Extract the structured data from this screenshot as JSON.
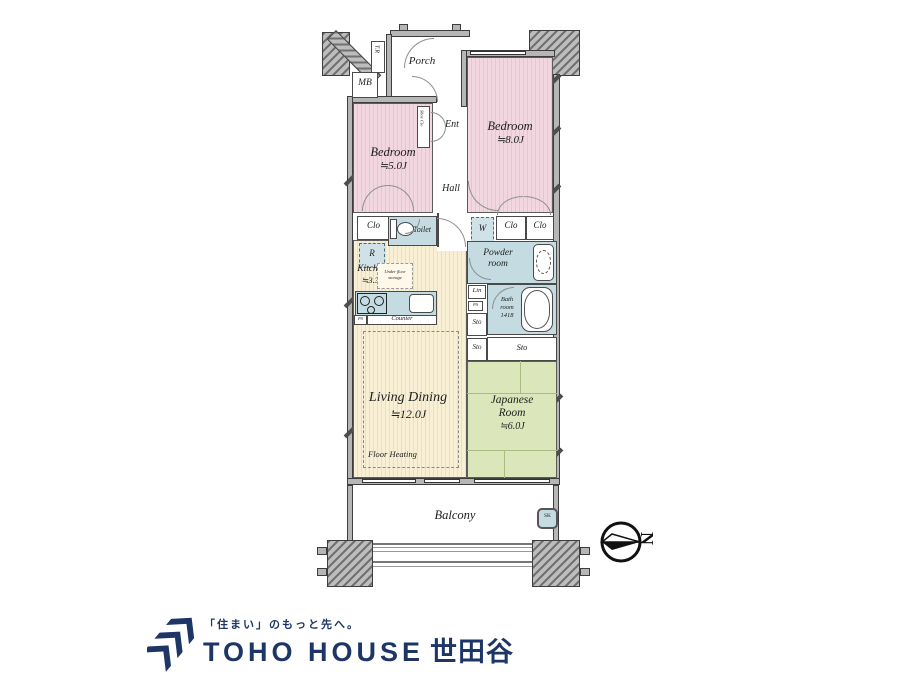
{
  "floorplan": {
    "rooms": {
      "porch": "Porch",
      "tr": "T.R",
      "mb": "MB",
      "shoe_clo": "Shoe Clo",
      "ent": "Ent",
      "hall": "Hall",
      "bedroom5_name": "Bedroom",
      "bedroom5_size": "≒5.0J",
      "bedroom8_name": "Bedroom",
      "bedroom8_size": "≒8.0J",
      "clo": "Clo",
      "ps": "PS",
      "toilet": "Toilet",
      "refrigerator": "R",
      "kitchen_name": "Kitchen",
      "kitchen_size": "≒3.3J",
      "underfloor_line1": "Under floor",
      "underfloor_line2": "storage",
      "counter": "Counter",
      "washer": "W",
      "powder_line1": "Powder",
      "powder_line2": "room",
      "lin": "Lin",
      "sto": "Sto",
      "bath_line1": "Bath",
      "bath_line2": "room",
      "bath_line3": "1418",
      "living_name": "Living Dining",
      "living_size": "≒12.0J",
      "floor_heating": "Floor Heating",
      "japanese_line1": "Japanese",
      "japanese_line2": "Room",
      "japanese_size": "≒6.0J",
      "balcony": "Balcony",
      "sk": "SK"
    },
    "compass": {
      "north": "N"
    }
  },
  "logo": {
    "tagline": "「住まい」のもっと先へ。",
    "brand": "TOHO HOUSE",
    "region": "世田谷"
  },
  "colors": {
    "bedroom_pink": "#f2d7e0",
    "japanese_green": "#dbe7ba",
    "living_cream": "#f8efd5",
    "wet_area_blue": "#c4dce1",
    "wall_gray": "#b6b6b6",
    "logo_navy": "#1d3666"
  }
}
